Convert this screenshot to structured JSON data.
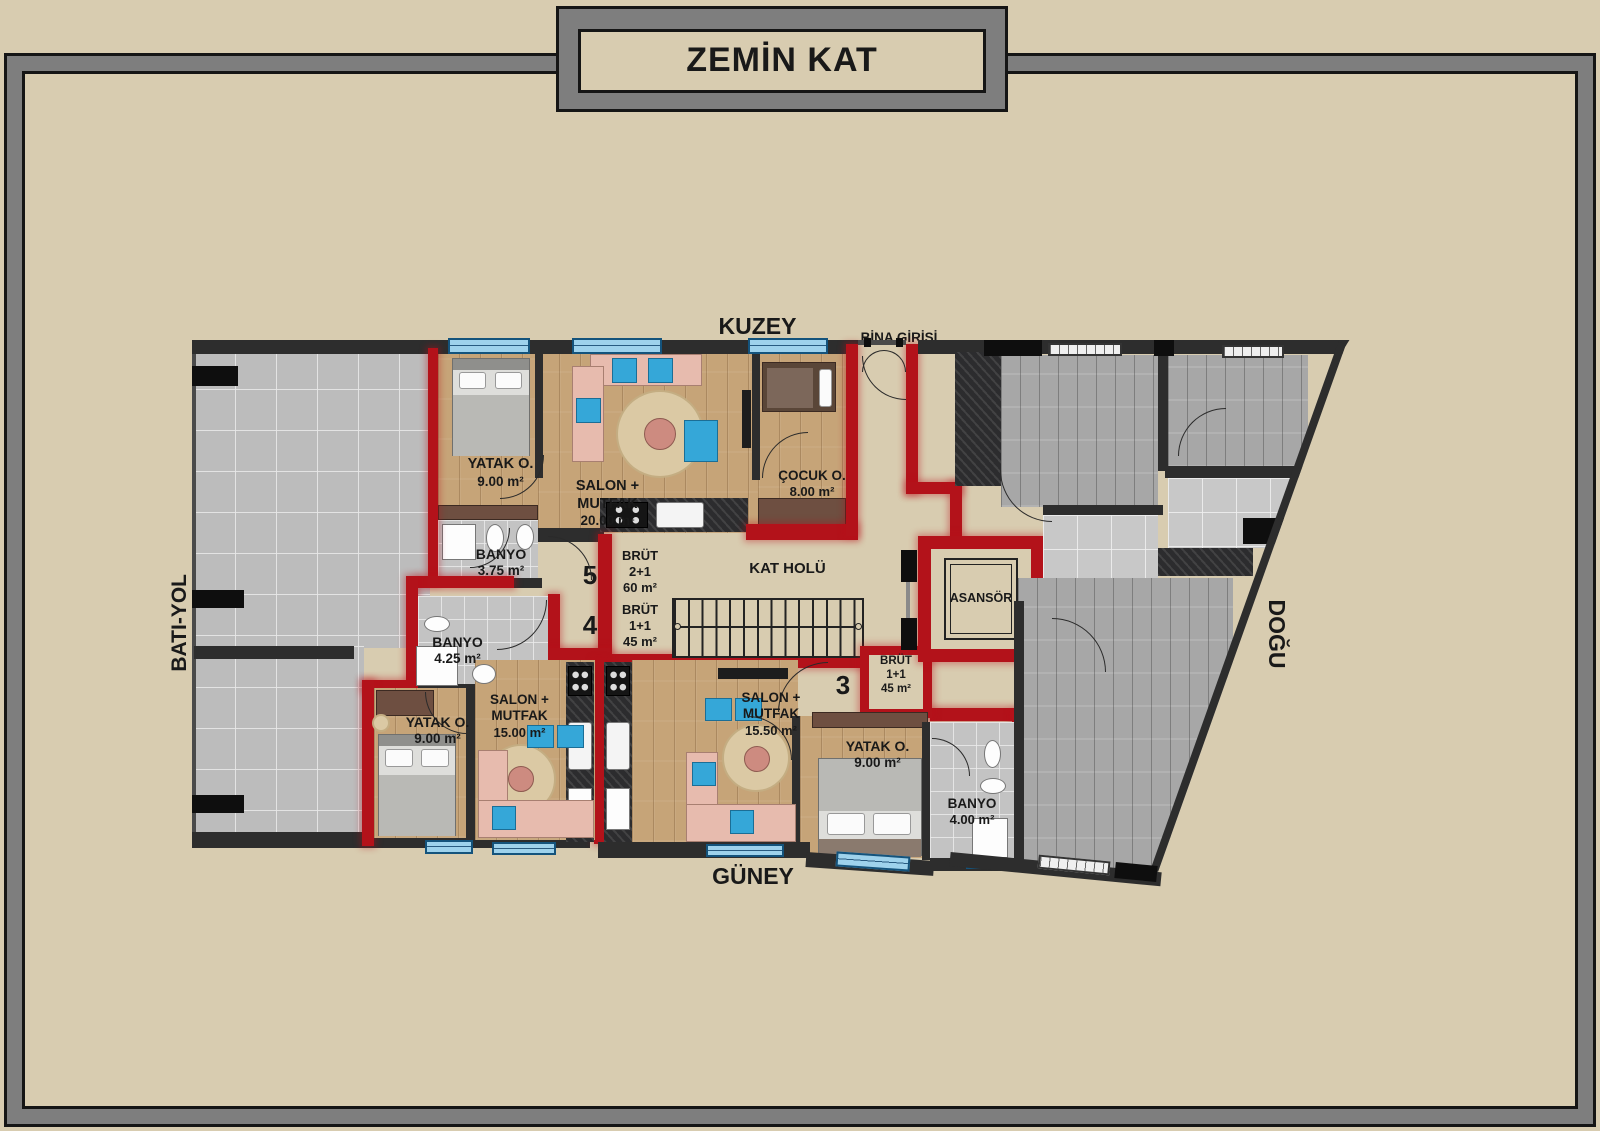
{
  "title": "ZEMİN KAT",
  "compass": {
    "north": "KUZEY",
    "south": "GÜNEY",
    "west": "BATI-YOL",
    "east": "DOĞU"
  },
  "entrance_label": "BİNA GİRİŞİ",
  "hall_label": "KAT HOLÜ",
  "elevator_label": "ASANSÖR",
  "units": {
    "unit5": {
      "number": "5",
      "brut_title": "BRÜT",
      "brut_type": "2+1",
      "brut_area": "60 m²",
      "bedroom_name": "YATAK O.",
      "bedroom_area": "9.00 m²",
      "salon_name": "SALON + MUTFAK",
      "salon_area": "20.00 m²",
      "child_name": "ÇOCUK O.",
      "child_area": "8.00 m²",
      "bath_name": "BANYO",
      "bath_area": "3.75 m²"
    },
    "unit4": {
      "number": "4",
      "brut_title": "BRÜT",
      "brut_type": "1+1",
      "brut_area": "45 m²",
      "bath_name": "BANYO",
      "bath_area": "4.25 m²",
      "salon_name": "SALON + MUTFAK",
      "salon_area": "15.00 m²",
      "bedroom_name": "YATAK O.",
      "bedroom_area": "9.00 m²"
    },
    "unit3": {
      "number": "3",
      "brut_title": "BRÜT",
      "brut_type": "1+1",
      "brut_area": "45 m²",
      "salon_name": "SALON + MUTFAK",
      "salon_area": "15.50 m²",
      "bedroom_name": "YATAK O.",
      "bedroom_area": "9.00 m²",
      "bath_name": "BANYO",
      "bath_area": "4.00 m²"
    }
  },
  "colors": {
    "background": "#d8ccb0",
    "frame_gray": "#7e7e7e",
    "wall_dark": "#2d2d2d",
    "unit_wall_red": "#b3121a",
    "window_blue": "#9ed2ec"
  }
}
